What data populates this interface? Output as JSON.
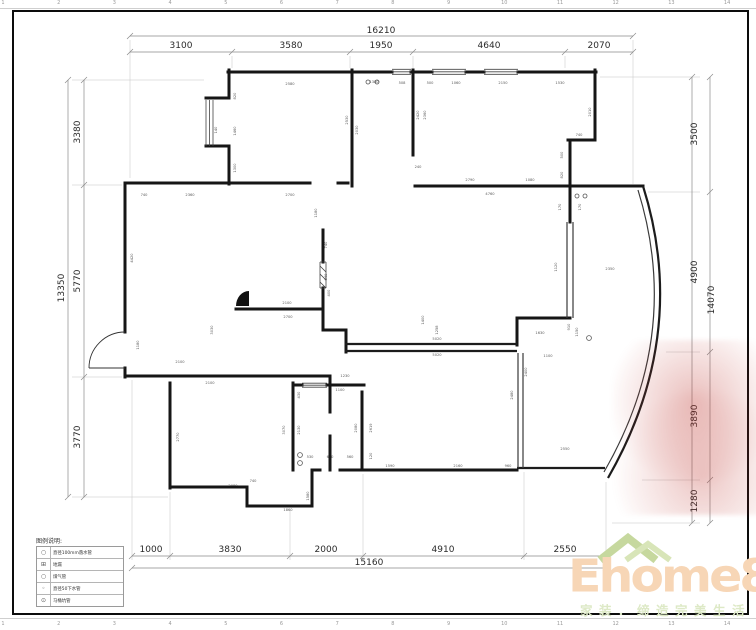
{
  "ruler": {
    "numbers": [
      "1",
      "2",
      "3",
      "4",
      "5",
      "6",
      "7",
      "8",
      "9",
      "10",
      "11",
      "12",
      "13",
      "14"
    ]
  },
  "dimensions": {
    "top": {
      "overall": "16210",
      "segments": [
        "3100",
        "3580",
        "1950",
        "4640",
        "2070"
      ]
    },
    "bottom": {
      "overall": "15160",
      "segments": [
        "1000",
        "3830",
        "2000",
        "4910",
        "2550"
      ]
    },
    "left": {
      "overall": "13350",
      "segments": [
        "3380",
        "5770",
        "3770"
      ]
    },
    "right": {
      "overall": "14070",
      "segments": [
        "3500",
        "4900",
        "3890",
        "1280"
      ]
    }
  },
  "small_dims": [
    {
      "t": "2580",
      "x": 290,
      "y": 85,
      "r": 0
    },
    {
      "t": "820",
      "x": 236,
      "y": 96,
      "r": 1
    },
    {
      "t": "1460",
      "x": 236,
      "y": 131,
      "r": 1
    },
    {
      "t": "1300",
      "x": 236,
      "y": 168,
      "r": 1
    },
    {
      "t": "140",
      "x": 217,
      "y": 130,
      "r": 1
    },
    {
      "t": "2530",
      "x": 348,
      "y": 120,
      "r": 1
    },
    {
      "t": "1380",
      "x": 374,
      "y": 83,
      "r": 0
    },
    {
      "t": "508",
      "x": 402,
      "y": 84,
      "r": 0
    },
    {
      "t": "2030",
      "x": 358,
      "y": 130,
      "r": 1
    },
    {
      "t": "500",
      "x": 430,
      "y": 84,
      "r": 0
    },
    {
      "t": "1060",
      "x": 456,
      "y": 84,
      "r": 0
    },
    {
      "t": "2150",
      "x": 503,
      "y": 84,
      "r": 0
    },
    {
      "t": "1530",
      "x": 560,
      "y": 84,
      "r": 0
    },
    {
      "t": "2420",
      "x": 419,
      "y": 115,
      "r": 1
    },
    {
      "t": "2360",
      "x": 426,
      "y": 115,
      "r": 1
    },
    {
      "t": "2010",
      "x": 591,
      "y": 112,
      "r": 1
    },
    {
      "t": "740",
      "x": 579,
      "y": 136,
      "r": 0
    },
    {
      "t": "240",
      "x": 418,
      "y": 168,
      "r": 0
    },
    {
      "t": "740",
      "x": 144,
      "y": 196,
      "r": 0
    },
    {
      "t": "2360",
      "x": 190,
      "y": 196,
      "r": 0
    },
    {
      "t": "2700",
      "x": 290,
      "y": 196,
      "r": 0
    },
    {
      "t": "2790",
      "x": 470,
      "y": 181,
      "r": 0
    },
    {
      "t": "1080",
      "x": 530,
      "y": 181,
      "r": 0
    },
    {
      "t": "4760",
      "x": 490,
      "y": 195,
      "r": 0
    },
    {
      "t": "500",
      "x": 563,
      "y": 155,
      "r": 1
    },
    {
      "t": "820",
      "x": 563,
      "y": 175,
      "r": 1
    },
    {
      "t": "170",
      "x": 561,
      "y": 207,
      "r": 1
    },
    {
      "t": "170",
      "x": 581,
      "y": 207,
      "r": 1
    },
    {
      "t": "1120",
      "x": 557,
      "y": 267,
      "r": 1
    },
    {
      "t": "2350",
      "x": 610,
      "y": 270,
      "r": 0
    },
    {
      "t": "1180",
      "x": 317,
      "y": 213,
      "r": 1
    },
    {
      "t": "740",
      "x": 327,
      "y": 245,
      "r": 1
    },
    {
      "t": "840",
      "x": 327,
      "y": 277,
      "r": 1
    },
    {
      "t": "400",
      "x": 330,
      "y": 293,
      "r": 1
    },
    {
      "t": "4420",
      "x": 133,
      "y": 258,
      "r": 1
    },
    {
      "t": "2100",
      "x": 287,
      "y": 304,
      "r": 0
    },
    {
      "t": "2700",
      "x": 288,
      "y": 318,
      "r": 0
    },
    {
      "t": "1180",
      "x": 139,
      "y": 345,
      "r": 1
    },
    {
      "t": "2100",
      "x": 180,
      "y": 363,
      "r": 0
    },
    {
      "t": "2100",
      "x": 210,
      "y": 384,
      "r": 0
    },
    {
      "t": "3030",
      "x": 213,
      "y": 330,
      "r": 1
    },
    {
      "t": "2770",
      "x": 179,
      "y": 437,
      "r": 1
    },
    {
      "t": "2080",
      "x": 233,
      "y": 487,
      "r": 0
    },
    {
      "t": "1860",
      "x": 288,
      "y": 511,
      "r": 0
    },
    {
      "t": "1580",
      "x": 309,
      "y": 496,
      "r": 1
    },
    {
      "t": "740",
      "x": 253,
      "y": 482,
      "r": 0
    },
    {
      "t": "320",
      "x": 297,
      "y": 377,
      "r": 0
    },
    {
      "t": "610",
      "x": 313,
      "y": 377,
      "r": 0
    },
    {
      "t": "1230",
      "x": 345,
      "y": 377,
      "r": 0
    },
    {
      "t": "1100",
      "x": 340,
      "y": 391,
      "r": 0
    },
    {
      "t": "430",
      "x": 300,
      "y": 395,
      "r": 1
    },
    {
      "t": "2130",
      "x": 300,
      "y": 430,
      "r": 1
    },
    {
      "t": "3070",
      "x": 285,
      "y": 430,
      "r": 1
    },
    {
      "t": "2080",
      "x": 357,
      "y": 428,
      "r": 1
    },
    {
      "t": "2619",
      "x": 372,
      "y": 428,
      "r": 1
    },
    {
      "t": "530",
      "x": 310,
      "y": 458,
      "r": 0
    },
    {
      "t": "690",
      "x": 330,
      "y": 458,
      "r": 0
    },
    {
      "t": "560",
      "x": 350,
      "y": 458,
      "r": 0
    },
    {
      "t": "120",
      "x": 372,
      "y": 456,
      "r": 1
    },
    {
      "t": "1590",
      "x": 390,
      "y": 467,
      "r": 0
    },
    {
      "t": "2160",
      "x": 458,
      "y": 467,
      "r": 0
    },
    {
      "t": "960",
      "x": 508,
      "y": 467,
      "r": 0
    },
    {
      "t": "5020",
      "x": 437,
      "y": 340,
      "r": 0
    },
    {
      "t": "5020",
      "x": 437,
      "y": 356,
      "r": 0
    },
    {
      "t": "1630",
      "x": 540,
      "y": 334,
      "r": 0
    },
    {
      "t": "1100",
      "x": 548,
      "y": 357,
      "r": 0
    },
    {
      "t": "1150",
      "x": 578,
      "y": 332,
      "r": 1
    },
    {
      "t": "910",
      "x": 570,
      "y": 327,
      "r": 1
    },
    {
      "t": "2480",
      "x": 513,
      "y": 395,
      "r": 1
    },
    {
      "t": "2400",
      "x": 527,
      "y": 372,
      "r": 1
    },
    {
      "t": "2550",
      "x": 565,
      "y": 450,
      "r": 0
    },
    {
      "t": "1400",
      "x": 424,
      "y": 320,
      "r": 1
    },
    {
      "t": "1258",
      "x": 438,
      "y": 330,
      "r": 1
    }
  ],
  "legend": {
    "title": "图例说明:",
    "rows": [
      {
        "icon": "○",
        "icon_name": "downpipe-circle-icon",
        "label": "直径100mm落水管"
      },
      {
        "icon": "⊞",
        "icon_name": "floor-drain-icon",
        "label": "地漏"
      },
      {
        "icon": "○",
        "icon_name": "gas-pipe-icon",
        "label": "煤气管"
      },
      {
        "icon": "◦",
        "icon_name": "drain-pipe-icon",
        "label": "直径50下水管"
      },
      {
        "icon": "⊙",
        "icon_name": "toilet-pipe-icon",
        "label": "马桶坑管"
      }
    ]
  },
  "logo": {
    "name": "Ehome8",
    "tagline": "家装．缔造完美生活",
    "brand_color": "#f7d6b6",
    "tagline_color": "#dde9c6",
    "roof_color": "#c6d89e"
  },
  "watermark": {
    "color": "#be3730"
  }
}
